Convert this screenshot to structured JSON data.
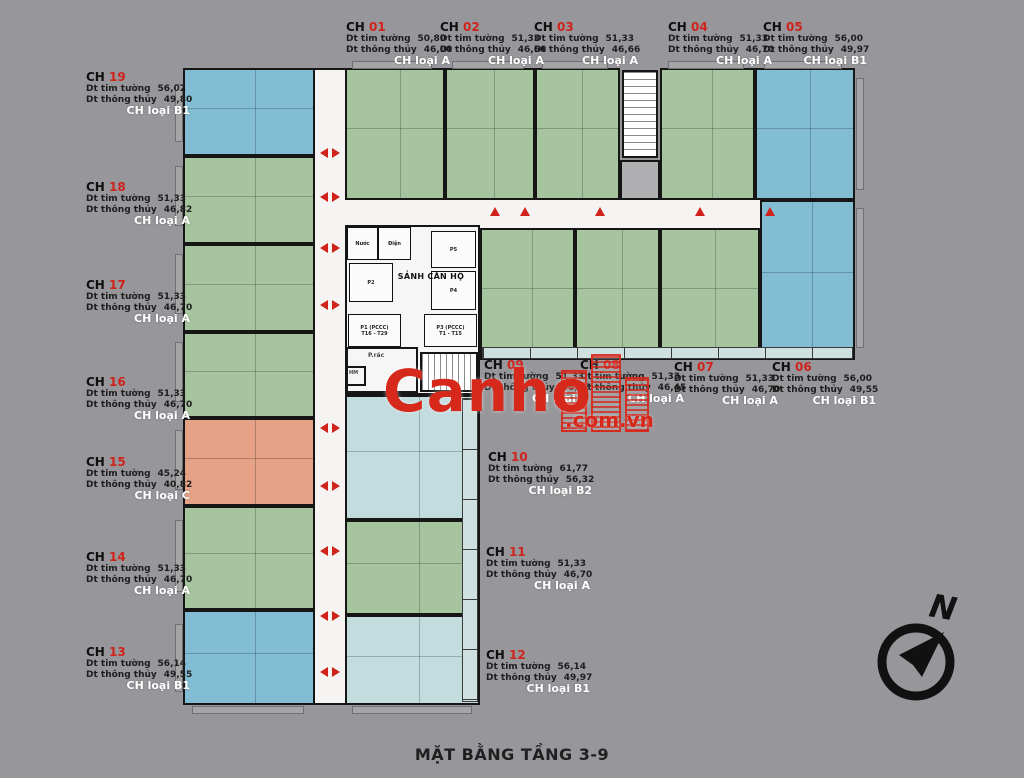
{
  "title": "MẶT BẰNG TẦNG 3-9",
  "watermark": {
    "brand": "Canho",
    "suffix": ".com.vn"
  },
  "compass": {
    "label": "N"
  },
  "field_labels": {
    "tim": "Dt tim tường",
    "thong": "Dt thông thủy"
  },
  "apartments": [
    {
      "code": "CH",
      "number": "01",
      "tim": "50,80",
      "thong": "46,00",
      "type": "CH loại A"
    },
    {
      "code": "CH",
      "number": "02",
      "tim": "51,33",
      "thong": "46,66",
      "type": "CH loại A"
    },
    {
      "code": "CH",
      "number": "03",
      "tim": "51,33",
      "thong": "46,66",
      "type": "CH loại A"
    },
    {
      "code": "CH",
      "number": "04",
      "tim": "51,33",
      "thong": "46,70",
      "type": "CH loại A"
    },
    {
      "code": "CH",
      "number": "05",
      "tim": "56,00",
      "thong": "49,97",
      "type": "CH loại B1"
    },
    {
      "code": "CH",
      "number": "06",
      "tim": "56,00",
      "thong": "49,55",
      "type": "CH loại B1"
    },
    {
      "code": "CH",
      "number": "07",
      "tim": "51,33",
      "thong": "46,70",
      "type": "CH loại A"
    },
    {
      "code": "CH",
      "number": "08",
      "tim": "51,33",
      "thong": "46,45",
      "type": "CH loại A"
    },
    {
      "code": "CH",
      "number": "09",
      "tim": "51,33",
      "thong": "46,95",
      "type": "CH loại A"
    },
    {
      "code": "CH",
      "number": "10",
      "tim": "61,77",
      "thong": "56,32",
      "type": "CH loại B2"
    },
    {
      "code": "CH",
      "number": "11",
      "tim": "51,33",
      "thong": "46,70",
      "type": "CH loại A"
    },
    {
      "code": "CH",
      "number": "12",
      "tim": "56,14",
      "thong": "49,97",
      "type": "CH loại B1"
    },
    {
      "code": "CH",
      "number": "13",
      "tim": "56,14",
      "thong": "49,55",
      "type": "CH loại B1"
    },
    {
      "code": "CH",
      "number": "14",
      "tim": "51,33",
      "thong": "46,70",
      "type": "CH loại A"
    },
    {
      "code": "CH",
      "number": "15",
      "tim": "45,24",
      "thong": "40,82",
      "type": "CH loại C"
    },
    {
      "code": "CH",
      "number": "16",
      "tim": "51,33",
      "thong": "46,70",
      "type": "CH loại A"
    },
    {
      "code": "CH",
      "number": "17",
      "tim": "51,33",
      "thong": "46,70",
      "type": "CH loại A"
    },
    {
      "code": "CH",
      "number": "18",
      "tim": "51,33",
      "thong": "46,82",
      "type": "CH loại A"
    },
    {
      "code": "CH",
      "number": "19",
      "tim": "56,02",
      "thong": "49,80",
      "type": "CH loại B1"
    }
  ],
  "core": {
    "lobby": "SẢNH CĂN HỘ",
    "water_room": "Nước",
    "electric_room": "Điện",
    "lift_p2": "P2",
    "lift_p4": "P4",
    "lift_p5": "P5",
    "fire1_name": "P1 (PCCC)",
    "fire1_floors": "T16 - T29",
    "fire2_name": "P3 (PCCC)",
    "fire2_floors": "T1 - T15",
    "trash": "P.rác",
    "hm": "HM"
  },
  "colors": {
    "background": "#97969a",
    "unit_a": "#a6c49d",
    "unit_b1": "#82bdd3",
    "unit_b2": "#c3dcde",
    "unit_c": "#e5a287",
    "corridor": "#f5f4f2",
    "wall": "#161616",
    "accent": "#cf231c"
  }
}
